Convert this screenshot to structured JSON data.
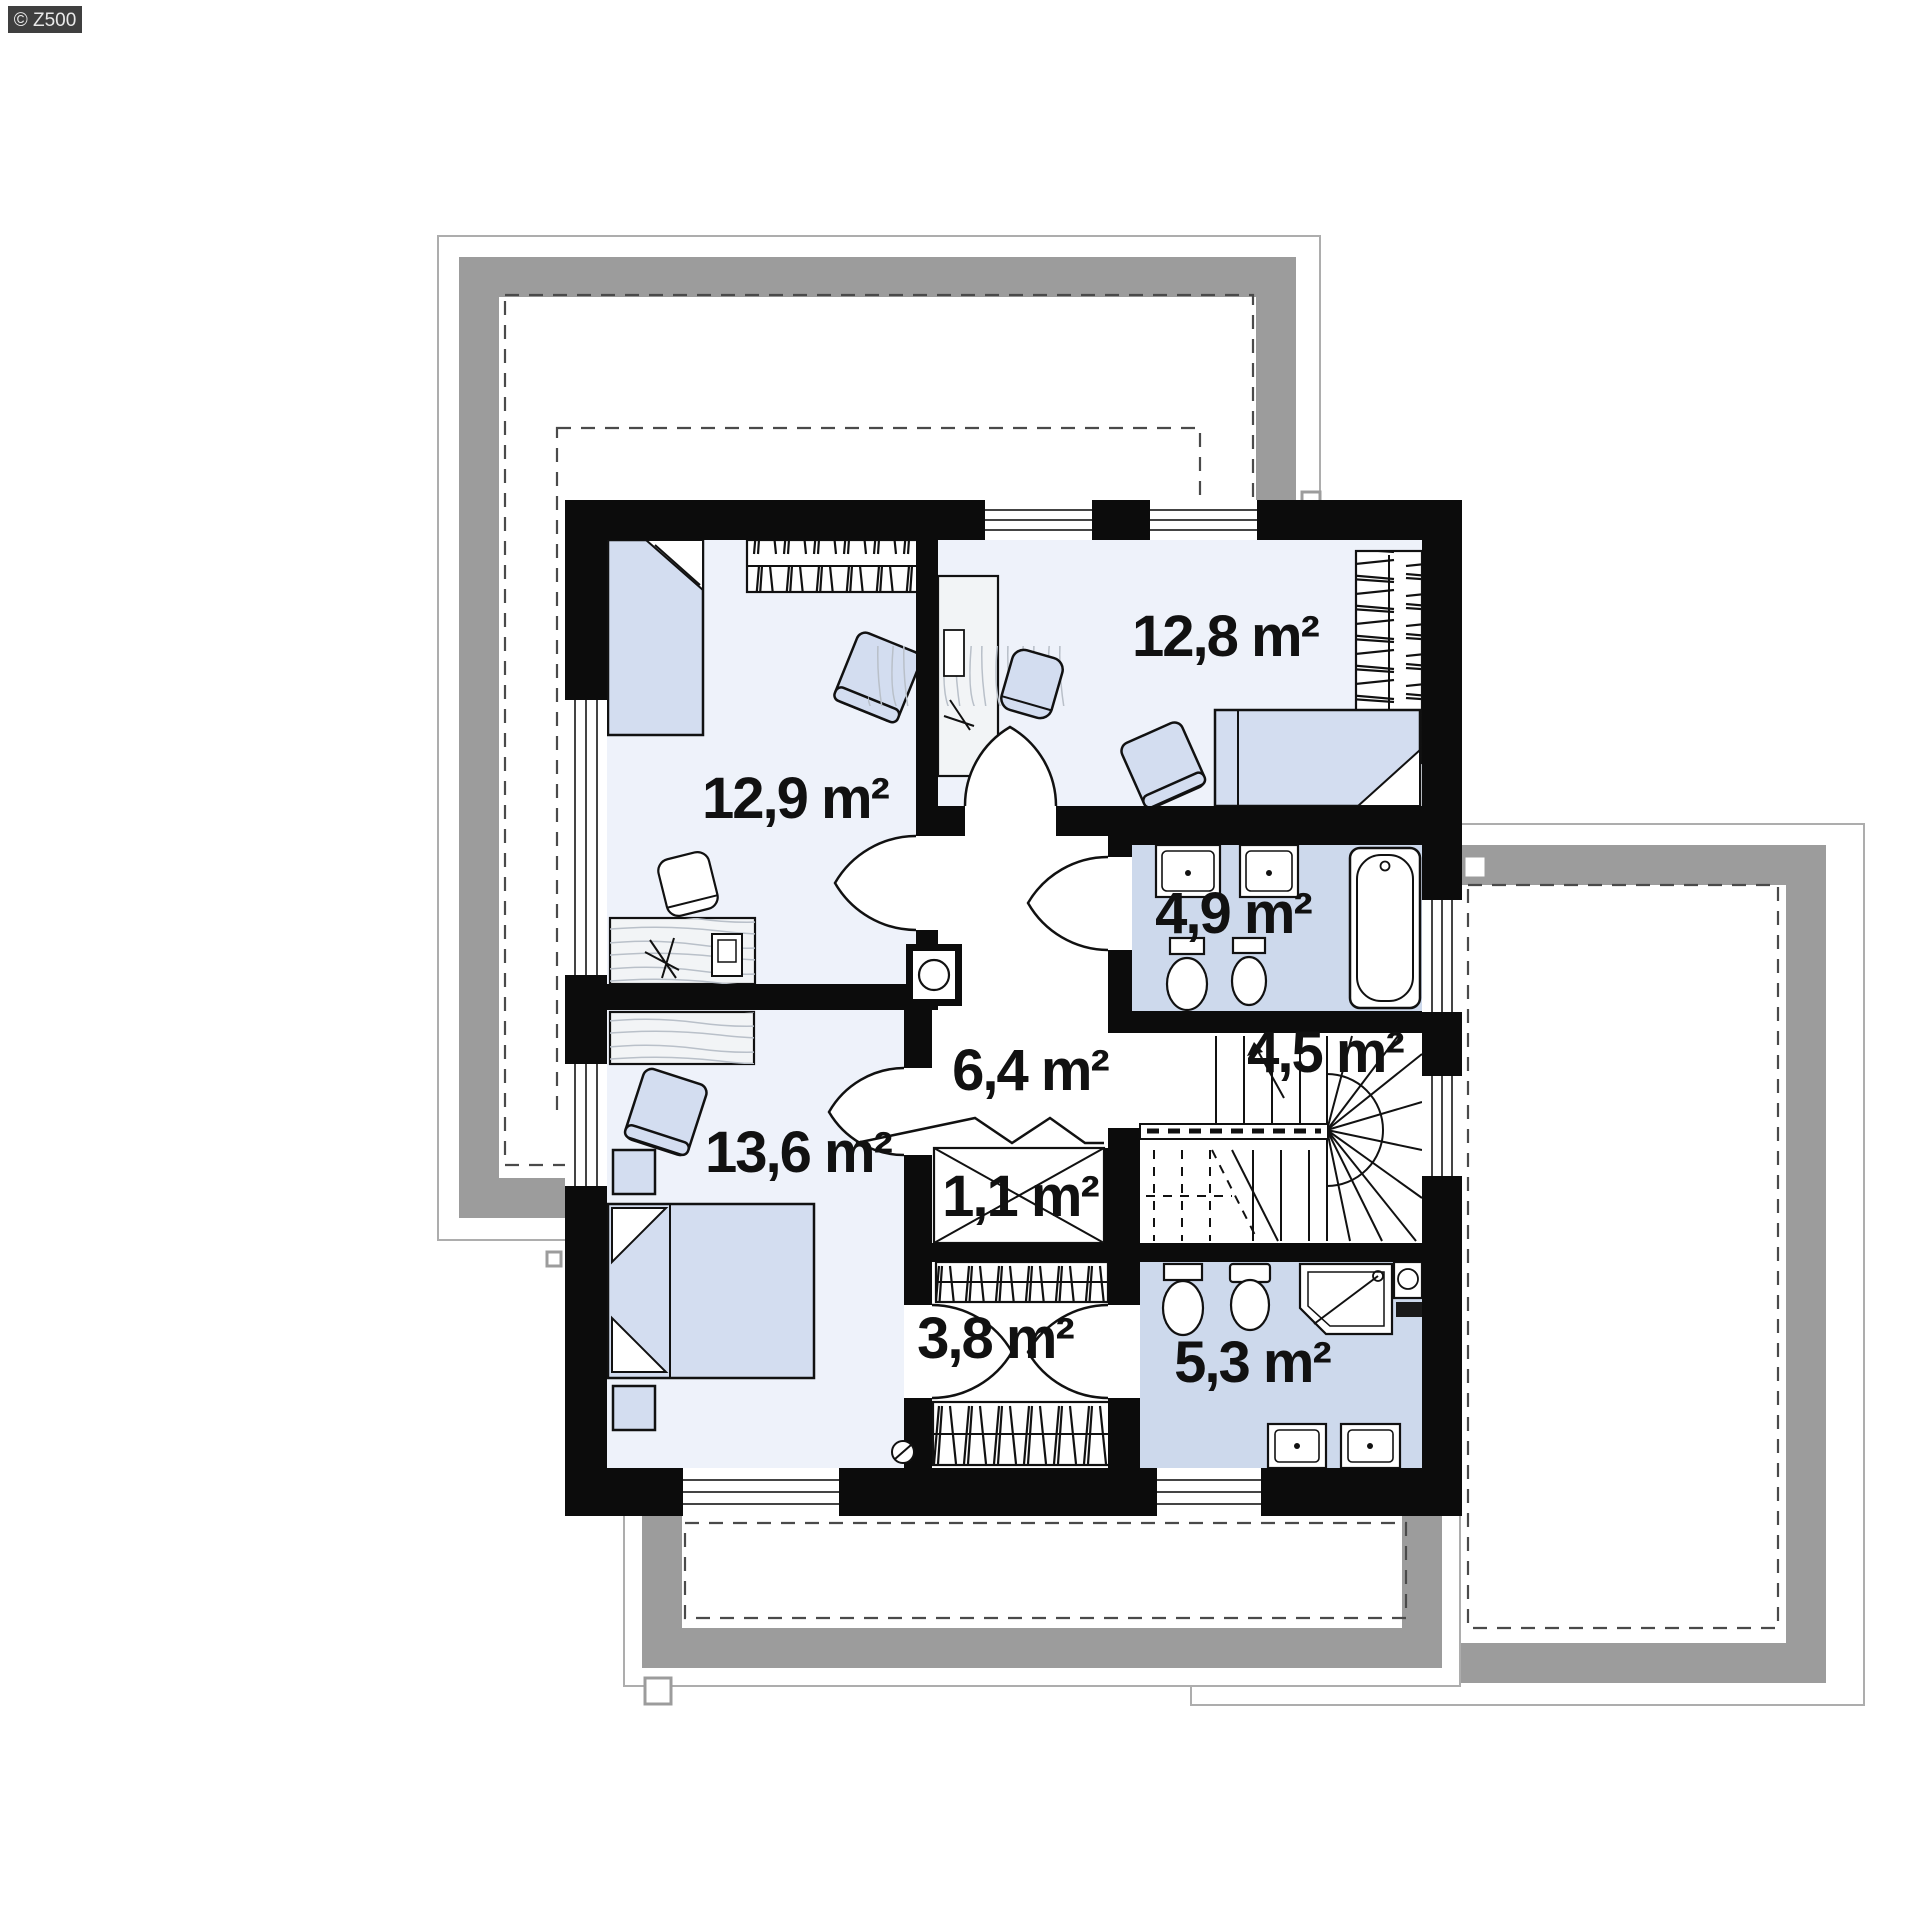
{
  "watermark": {
    "label": "© Z500"
  },
  "rooms": {
    "bedroom_upper_left": {
      "area": "12,9 m²"
    },
    "bedroom_upper_right": {
      "area": "12,8 m²"
    },
    "bathroom_upper": {
      "area": "4,9 m²"
    },
    "hallway": {
      "area": "6,4 m²"
    },
    "staircase": {
      "area": "4,5 m²"
    },
    "closet": {
      "area": "1,1 m²"
    },
    "bedroom_lower": {
      "area": "13,6 m²"
    },
    "corridor": {
      "area": "3,8 m²"
    },
    "bathroom_lower": {
      "area": "5,3 m²"
    }
  },
  "colors": {
    "wall": "#0c0c0c",
    "room_floor": "#eef2fa",
    "bathroom_floor": "#cdd9ec",
    "furniture_blue": "#d3ddf0",
    "roof_gray": "#9c9c9c",
    "watermark_bg": "#3f3f3f"
  }
}
